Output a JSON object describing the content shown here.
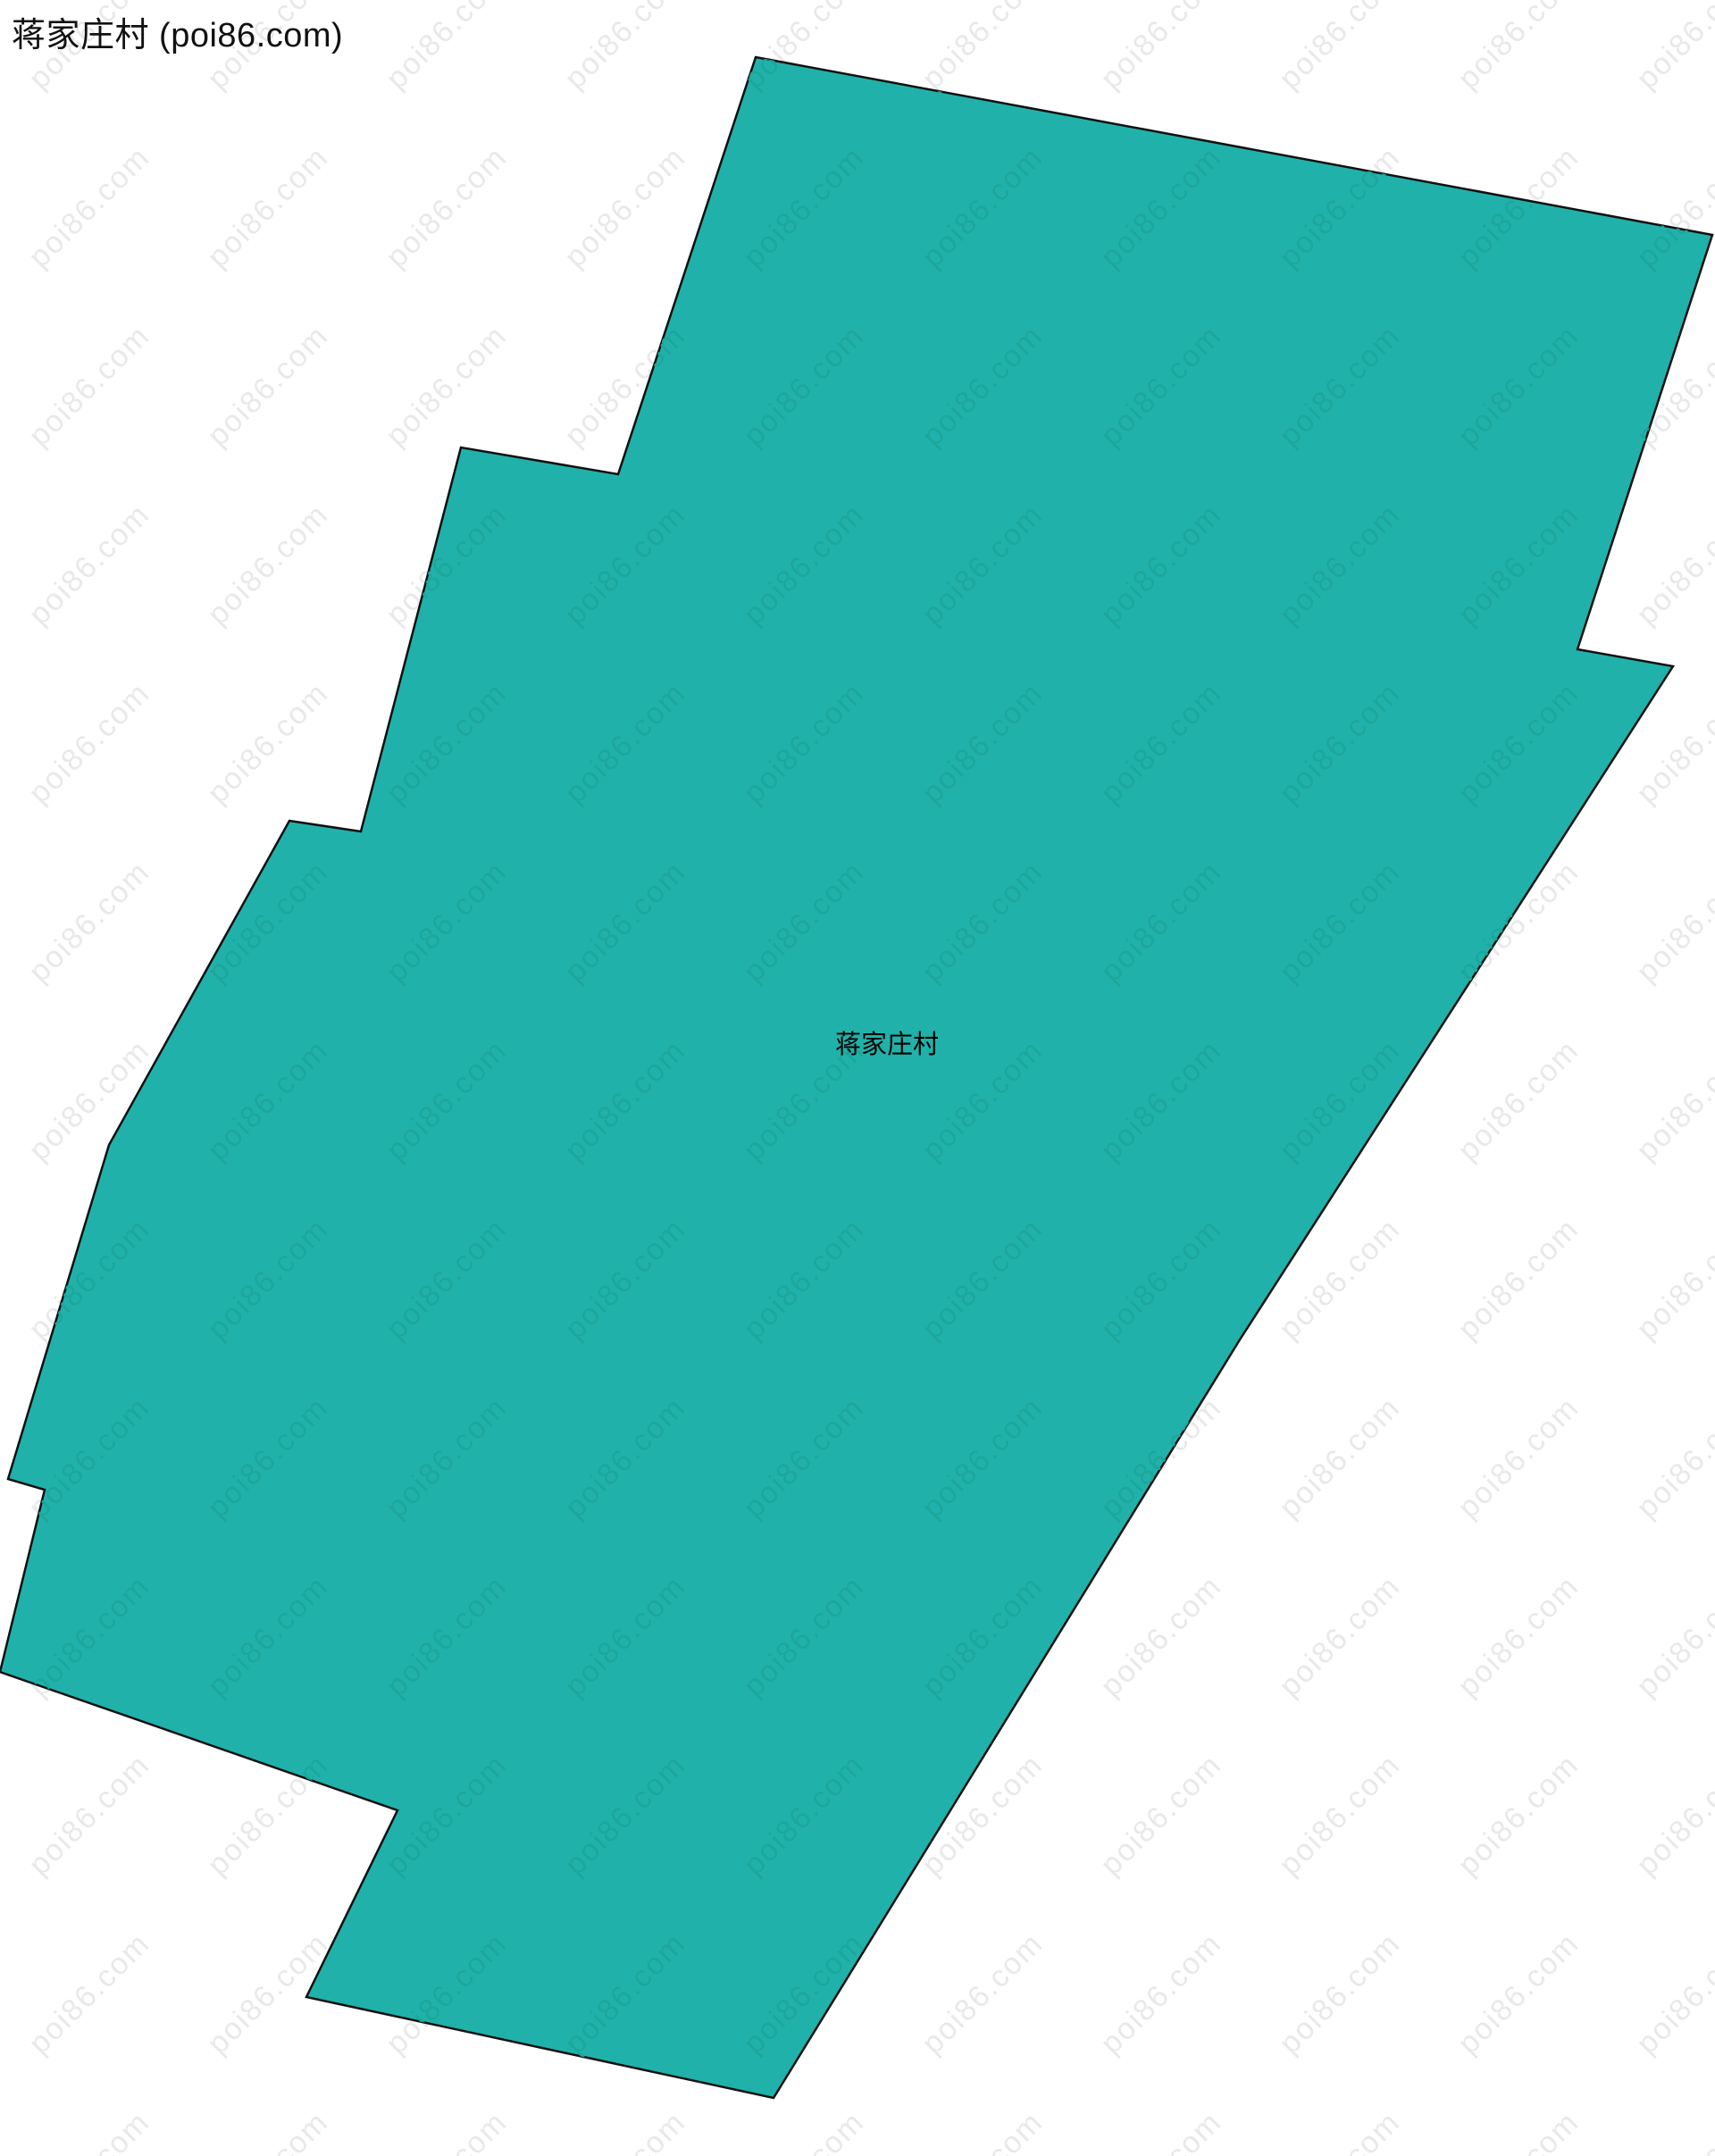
{
  "header": {
    "title": "蒋家庄村 (poi86.com)"
  },
  "map": {
    "region_label": "蒋家庄村",
    "polygon_points": "846,64 1917,263 1766,727 1873,746 1388,1500 866,2349 343,2236 445,2027 0,1872 50,1668 9,1656 122,1282 324,919 404,931 516,501 692,531",
    "border_width": "2.5"
  },
  "watermark": {
    "text": "poi86.com"
  },
  "colors": {
    "region_fill": "#20b2aa",
    "region_border": "#111111",
    "watermark_on_white": "#e9e9e9",
    "watermark_on_region": "#1da69b",
    "background": "#ffffff"
  }
}
